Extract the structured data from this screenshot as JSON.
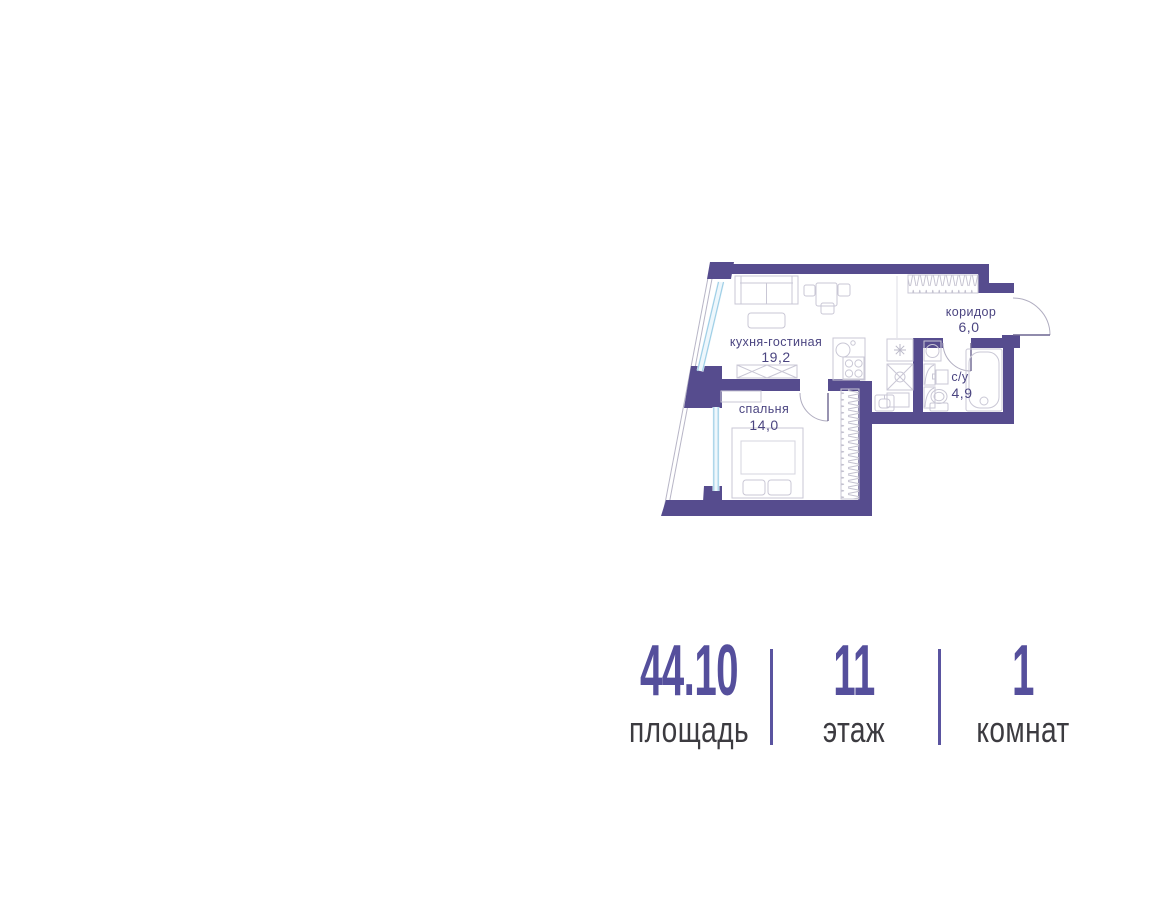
{
  "floor_plan": {
    "rooms": [
      {
        "name": "кухня-гостиная",
        "area": "19,2"
      },
      {
        "name": "спальня",
        "area": "14,0"
      },
      {
        "name": "коридор",
        "area": "6,0"
      },
      {
        "name": "с/у",
        "area": "4,9"
      }
    ],
    "colors": {
      "wall": "#564c8e",
      "window_line": "#9fcfe6",
      "furniture_line": "#c9c7d5",
      "room_label": "#4b4581"
    }
  },
  "stats": {
    "items": [
      {
        "value": "44.10",
        "label": "площадь"
      },
      {
        "value": "11",
        "label": "этаж"
      },
      {
        "value": "1",
        "label": "комнат"
      }
    ],
    "value_color": "#554f9c",
    "label_color": "#3c3b40",
    "divider_color": "#5a54a0"
  }
}
